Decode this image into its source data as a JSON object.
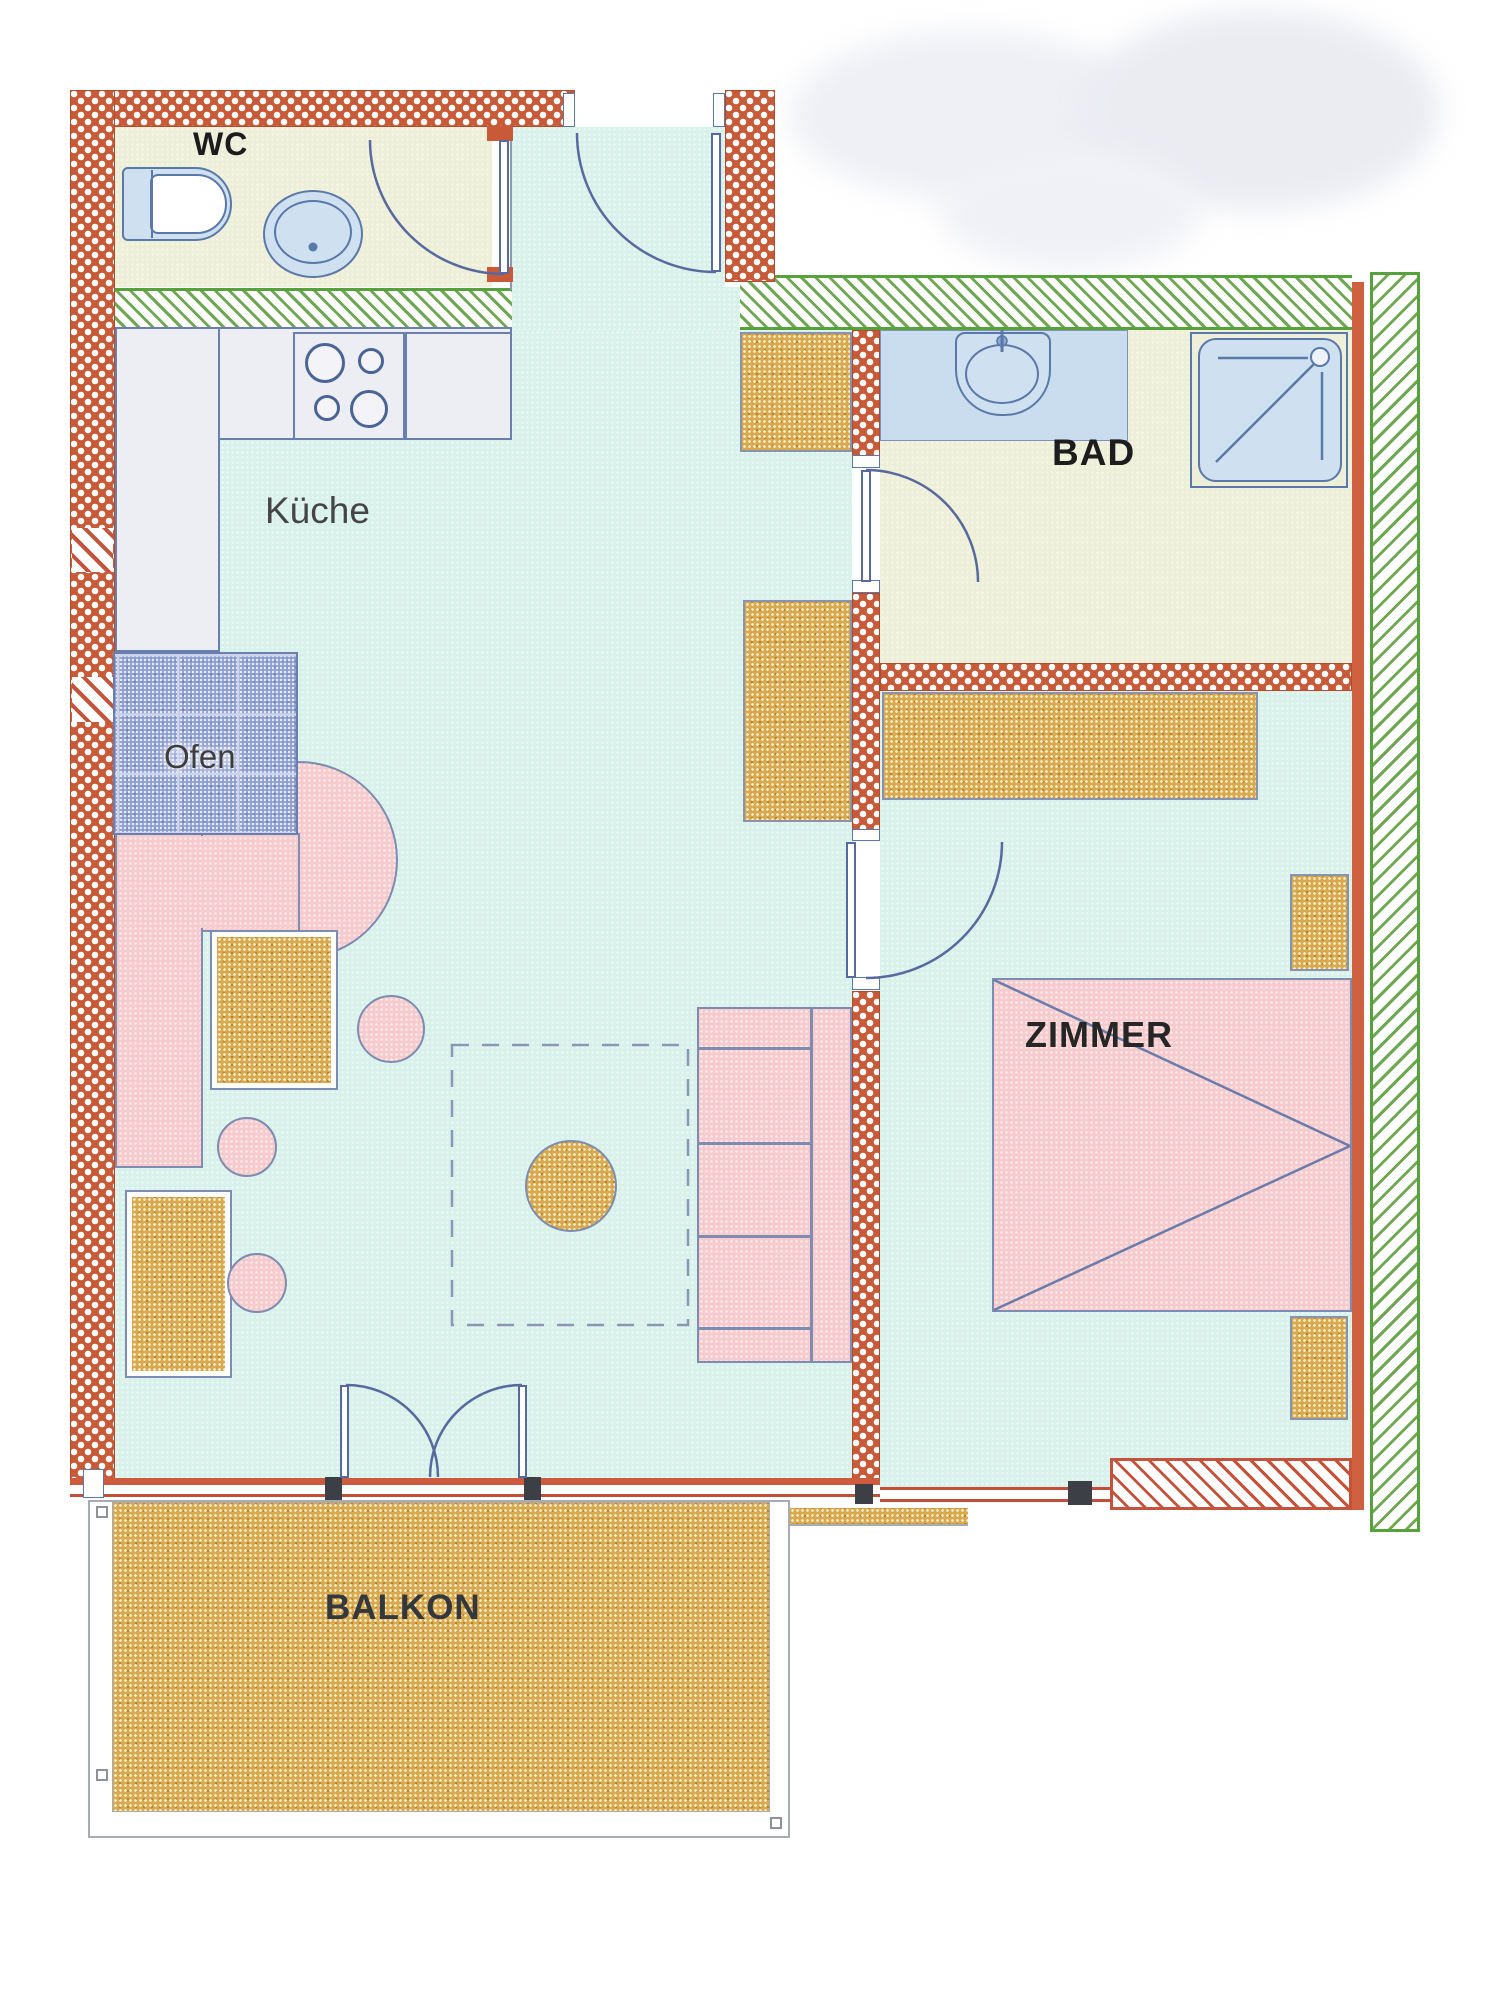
{
  "labels": {
    "wc": "WC",
    "kitchen": "Küche",
    "oven": "Ofen",
    "bath": "BAD",
    "room": "ZIMMER",
    "balcony": "BALKON"
  },
  "colors": {
    "outer_wall_brick": "#c85a38",
    "party_wall_green": "#58a23e",
    "parapet_red_hatch": "#c5533b",
    "floor_living": "#d8f1eb",
    "floor_wc_bad": "#edefd9",
    "wet_zone_blue": "#c9ddee",
    "fixture_blue": "#cfe0f0",
    "furniture_pink": "#f6cbcd",
    "furniture_wood": "#d9a94f",
    "tiled_stove_blue": "#8b9bd0",
    "drawing_line_blue": "#57699e",
    "label_text": "#222222"
  }
}
